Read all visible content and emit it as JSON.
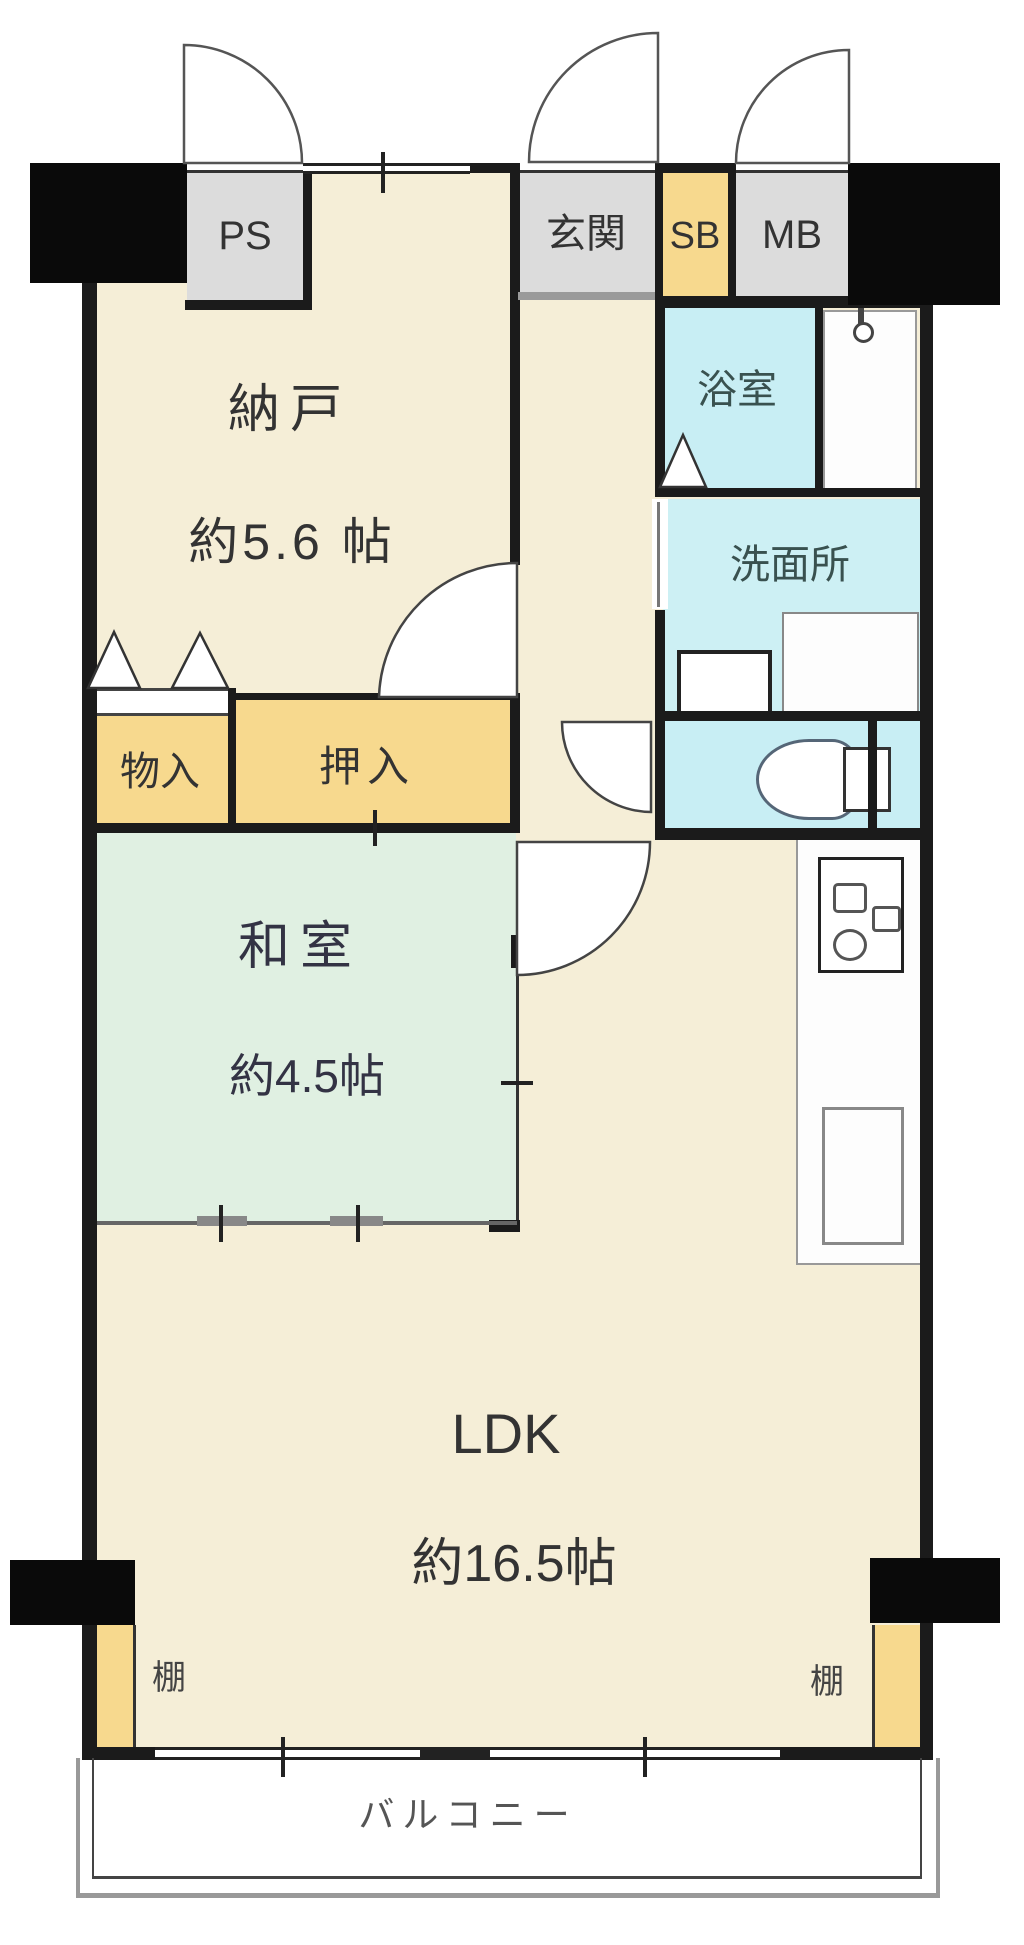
{
  "plan_title": "apartment-floorplan",
  "rooms": {
    "ps": {
      "label": "PS"
    },
    "genkan": {
      "label": "玄関"
    },
    "sb": {
      "label": "SB"
    },
    "mb": {
      "label": "MB"
    },
    "nando": {
      "label": "納戸",
      "size": "約5.6 帖"
    },
    "yokushitsu": {
      "label": "浴室"
    },
    "senmenjo": {
      "label": "洗面所"
    },
    "monoire": {
      "label": "物入"
    },
    "oshiire": {
      "label": "押入"
    },
    "washitsu": {
      "label": "和室",
      "size": "約4.5帖"
    },
    "ldk": {
      "label": "LDK",
      "size": "約16.5帖"
    },
    "tana_left": {
      "label": "棚"
    },
    "tana_right": {
      "label": "棚"
    },
    "balcony": {
      "label": "バルコニー"
    }
  },
  "colors": {
    "floor_beige": "#f5eed7",
    "tatami_green": "#e0f0e2",
    "closet_yellow": "#f7d98e",
    "wet_cyan": "#c8eef4",
    "entry_gray": "#dcdcdc",
    "wall_black": "#1b1b1b"
  }
}
